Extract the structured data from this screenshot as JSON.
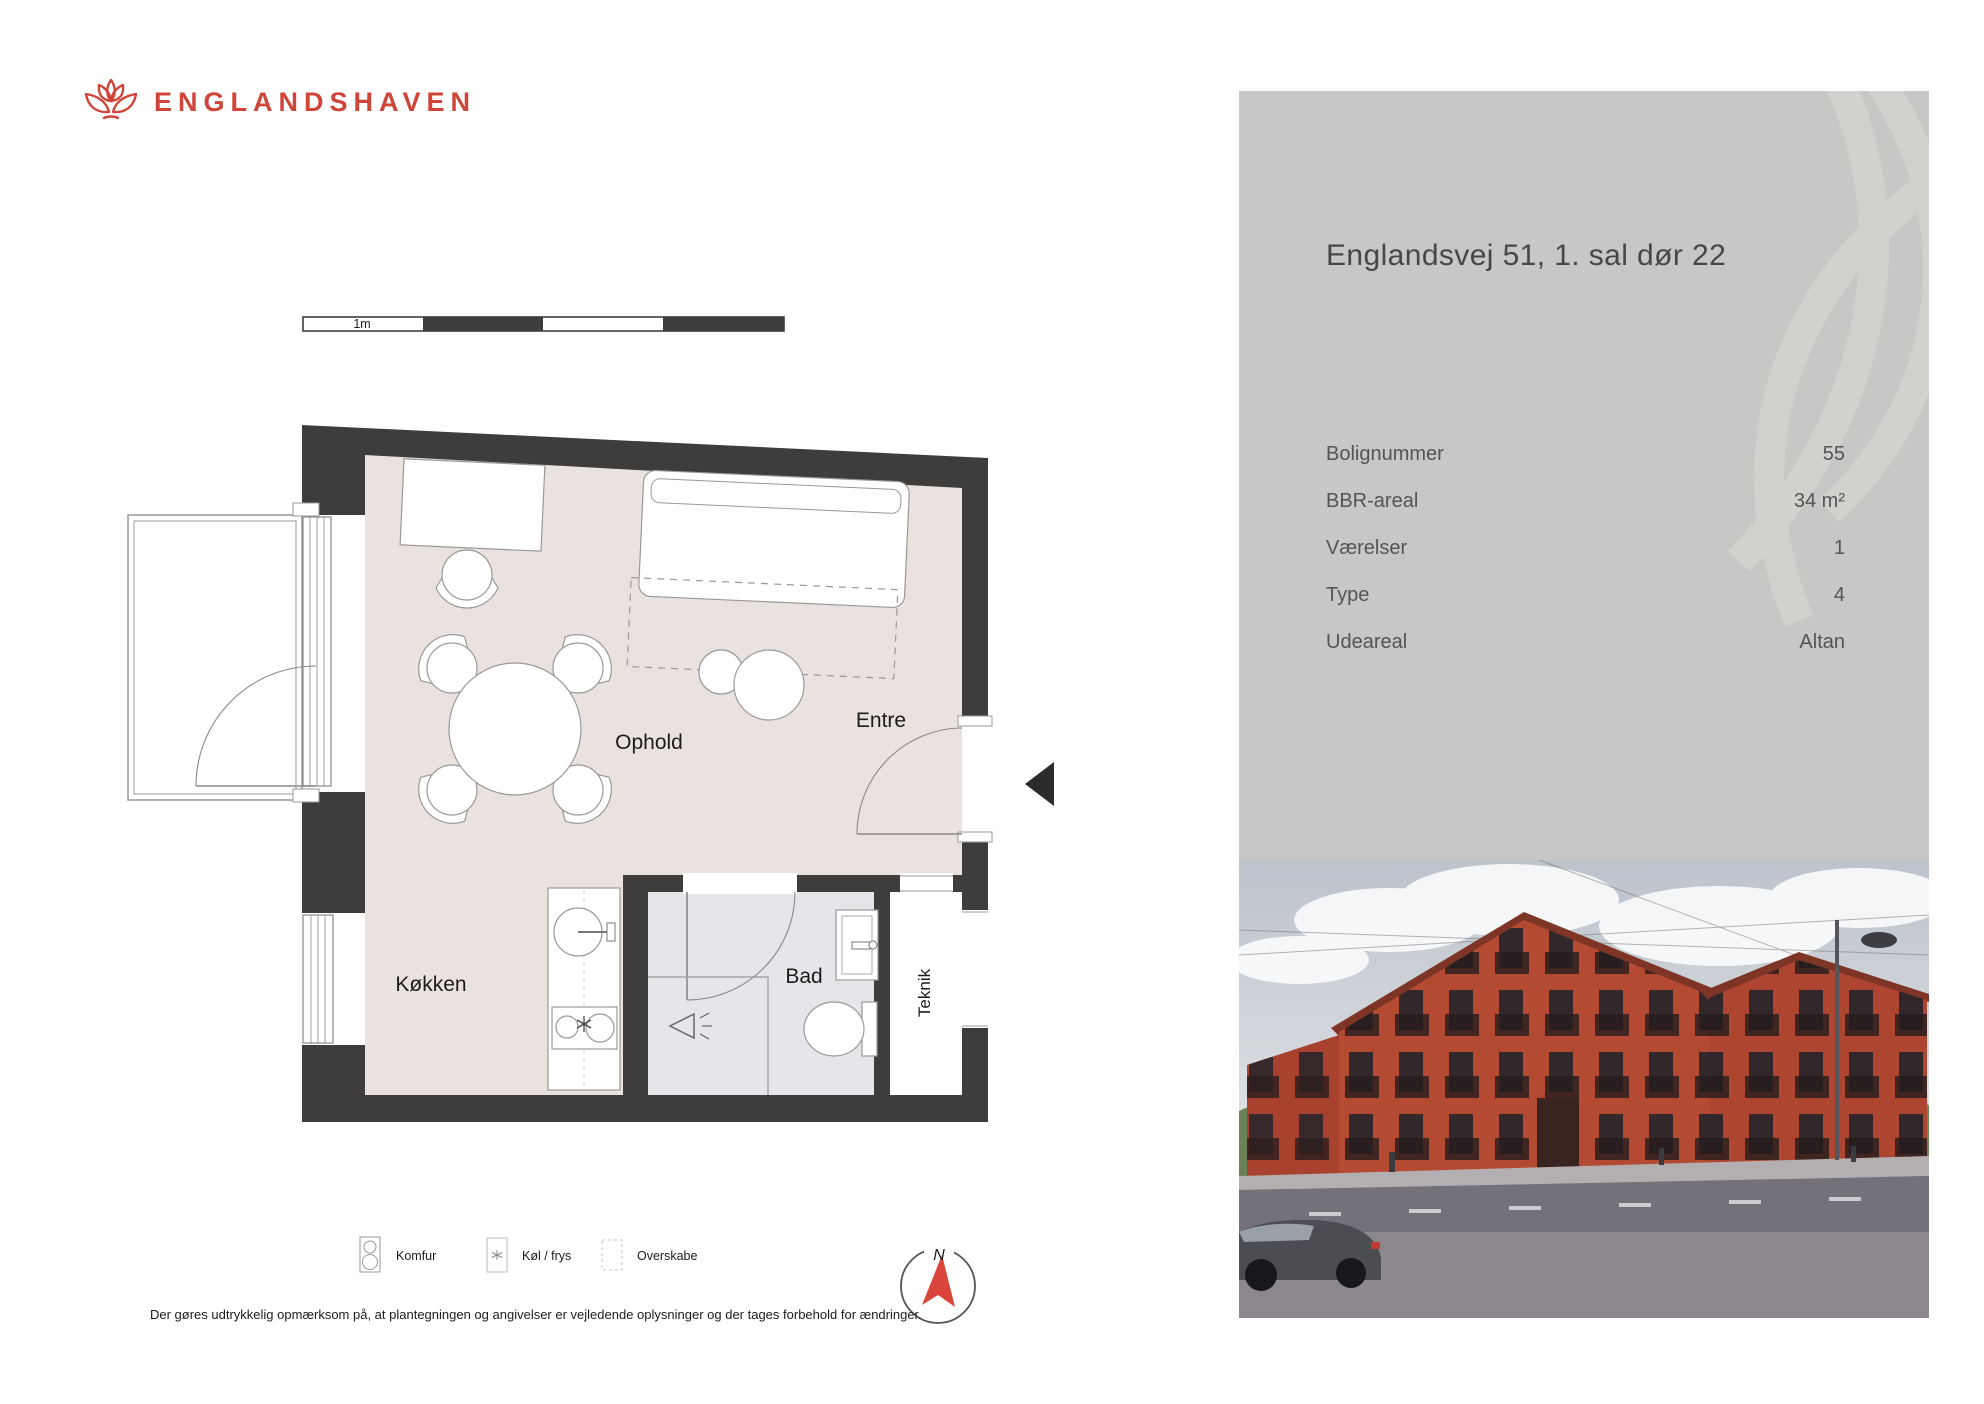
{
  "brand": {
    "name": "ENGLANDSHAVEN"
  },
  "scale_bar": {
    "label": "1m"
  },
  "plan": {
    "rooms": {
      "ophold": "Ophold",
      "entre": "Entre",
      "kokken": "Køkken",
      "bad": "Bad",
      "teknik": "Teknik"
    }
  },
  "legend": {
    "items": [
      {
        "label": "Komfur"
      },
      {
        "label": "Køl / frys"
      },
      {
        "label": "Overskabe"
      }
    ]
  },
  "compass": {
    "label": "N"
  },
  "disclaimer": "Der gøres udtrykkelig opmærksom på, at plantegningen og angivelser er vejledende oplysninger og der tages forbehold for ændringer.",
  "panel": {
    "title": "Englandsvej 51, 1. sal dør 22",
    "rows": [
      {
        "label": "Bolignummer",
        "value": "55"
      },
      {
        "label": "BBR-areal",
        "value": "34 m²"
      },
      {
        "label": "Værelser",
        "value": "1"
      },
      {
        "label": "Type",
        "value": "4"
      },
      {
        "label": "Udeareal",
        "value": "Altan"
      }
    ]
  },
  "colors": {
    "brand_red": "#d0453a",
    "wall_dark": "#3e3d3c",
    "floor_beige": "#eae2de",
    "bath_floor": "#e6e5e9",
    "panel_gray": "#c8c7c5",
    "north_red": "#d9453b"
  }
}
